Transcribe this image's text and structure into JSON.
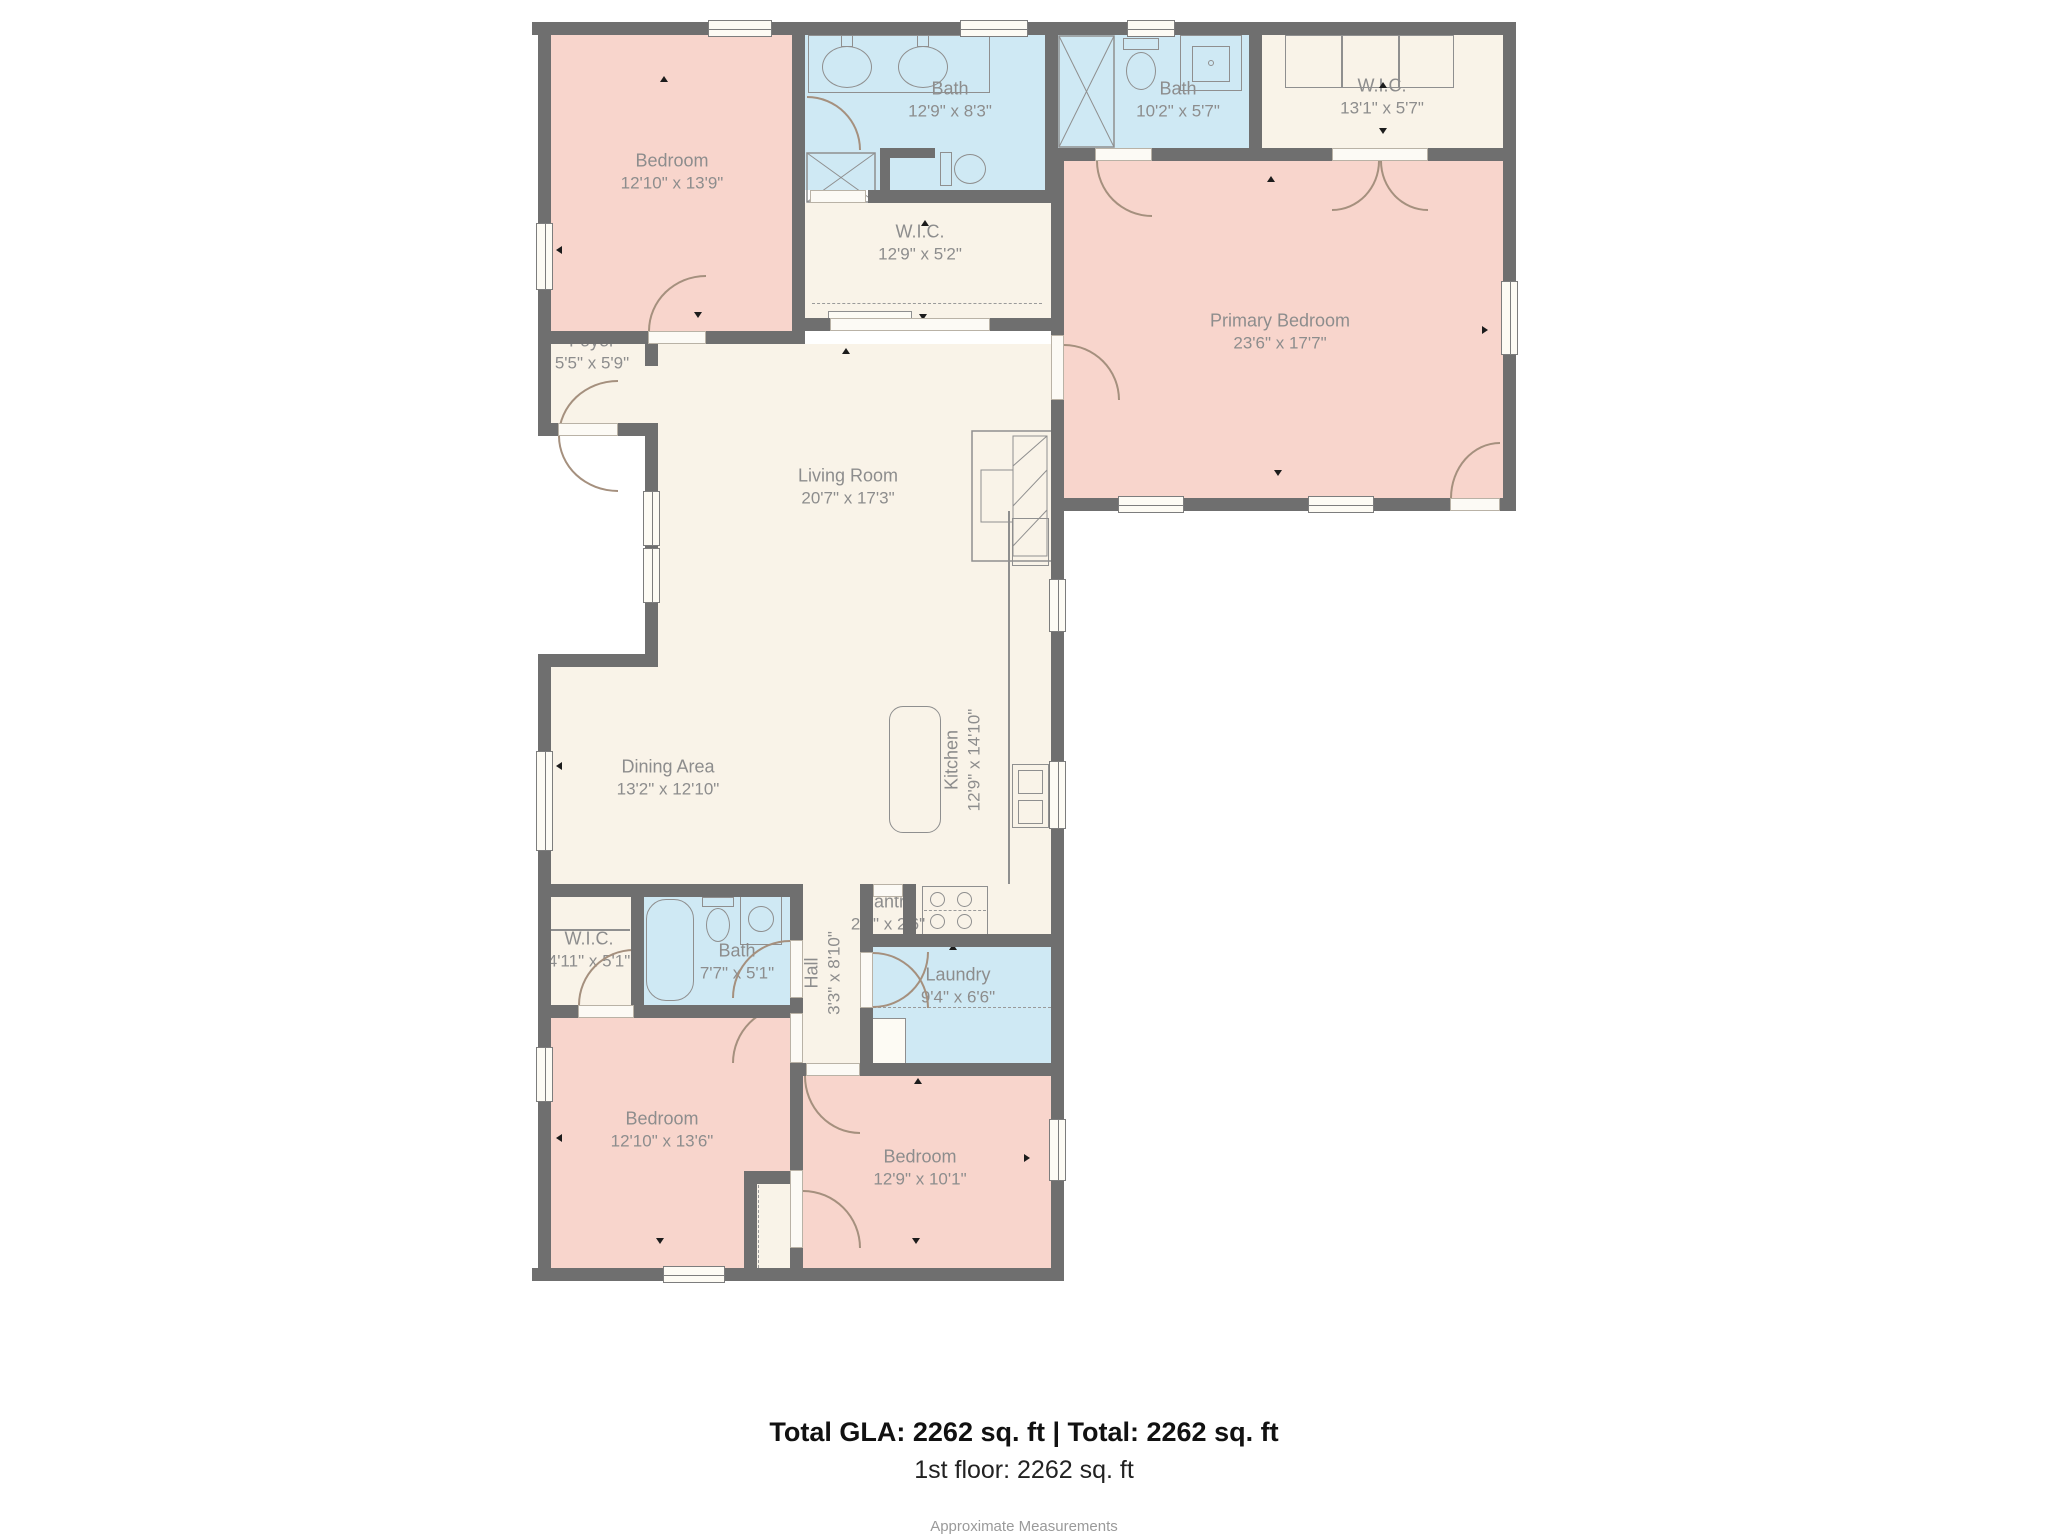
{
  "plan": {
    "rooms": [
      {
        "name": "Bedroom",
        "dims": "12'10\" x 13'9\""
      },
      {
        "name": "Bath",
        "dims": "12'9\" x 8'3\""
      },
      {
        "name": "Bath",
        "dims": "10'2\" x 5'7\""
      },
      {
        "name": "W.I.C.",
        "dims": "13'1\" x 5'7\""
      },
      {
        "name": "W.I.C.",
        "dims": "12'9\" x 5'2\""
      },
      {
        "name": "Foyer",
        "dims": "5'5\" x 5'9\""
      },
      {
        "name": "Primary Bedroom",
        "dims": "23'6\" x 17'7\""
      },
      {
        "name": "Living Room",
        "dims": "20'7\" x 17'3\""
      },
      {
        "name": "Dining Area",
        "dims": "13'2\" x 12'10\""
      },
      {
        "name": "Kitchen",
        "dims": "12'9\" x 14'10\""
      },
      {
        "name": "W.I.C.",
        "dims": "4'11\" x 5'1\""
      },
      {
        "name": "Bath",
        "dims": "7'7\" x 5'1\""
      },
      {
        "name": "Hall",
        "dims": "3'3\" x 8'10\""
      },
      {
        "name": "Pantry",
        "dims": "2'2\" x 2'6\""
      },
      {
        "name": "Laundry",
        "dims": "9'4\" x 6'6\""
      },
      {
        "name": "Bedroom",
        "dims": "12'10\" x 13'6\""
      },
      {
        "name": "Bedroom",
        "dims": "12'9\" x 10'1\""
      }
    ]
  },
  "footer": {
    "total_line": "Total GLA: 2262 sq. ft | Total: 2262 sq. ft",
    "floor_line": "1st floor: 2262 sq. ft",
    "note": "Approximate Measurements"
  },
  "colors": {
    "bedroom_fill": "#f8d5cc",
    "bath_fill": "#cfe9f4",
    "common_fill": "#f9f3e8",
    "wall": "#6f6f6f",
    "label_text": "#8d8d8d"
  },
  "icons": {
    "fixtures": [
      "shower-icon",
      "sink-icon",
      "toilet-icon",
      "bathtub-icon",
      "stove-icon",
      "kitchen-island",
      "fireplace",
      "window",
      "door-arc",
      "cabinet"
    ]
  }
}
